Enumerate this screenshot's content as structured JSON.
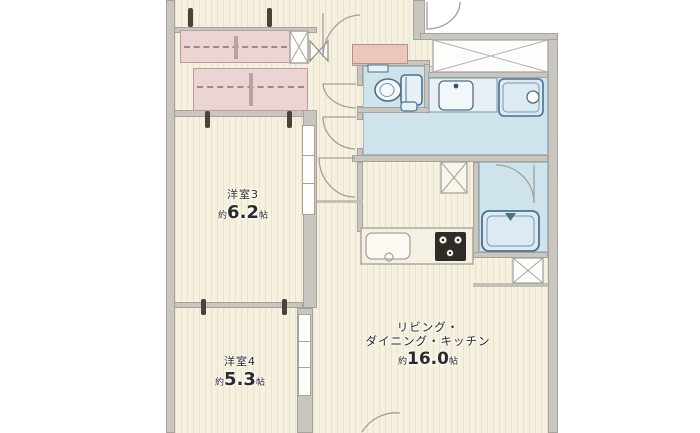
{
  "colors": {
    "floor": "#f6f1de",
    "stripe": "#e9e2c8",
    "wall": "#c9c6c0",
    "wall_edge": "#a6a39d",
    "closet": "#ecd4d2",
    "closet_border": "#b5a09e",
    "closet_line": "#a08884",
    "shoe_cabinet": "#eac7ba",
    "water": "#cfe3ed",
    "fixture_stroke": "#4a708c",
    "fixture_fill": "#dcebf3",
    "counter": "#f4f0e2",
    "stove": "#2e2b28",
    "text": "#2b2b2b"
  },
  "rooms": {
    "room3": {
      "name": "洋室3",
      "size_prefix": "約",
      "size_value": "6.2",
      "size_unit": "帖"
    },
    "room4": {
      "name": "洋室4",
      "size_prefix": "約",
      "size_value": "5.3",
      "size_unit": "帖"
    },
    "ldk": {
      "name_line1": "リビング・",
      "name_line2": "ダイニング・キッチン",
      "size_prefix": "約",
      "size_value": "16.0",
      "size_unit": "帖"
    }
  },
  "icons": [
    "toilet-icon",
    "washbasin-icon",
    "washing-machine-pan-icon",
    "bathtub-icon",
    "kitchen-sink-icon",
    "gas-stove-icon",
    "closet",
    "shoe-cabinet",
    "pipe-space-x",
    "porch-x",
    "folding-door-bowtie",
    "door-swing-arc"
  ]
}
